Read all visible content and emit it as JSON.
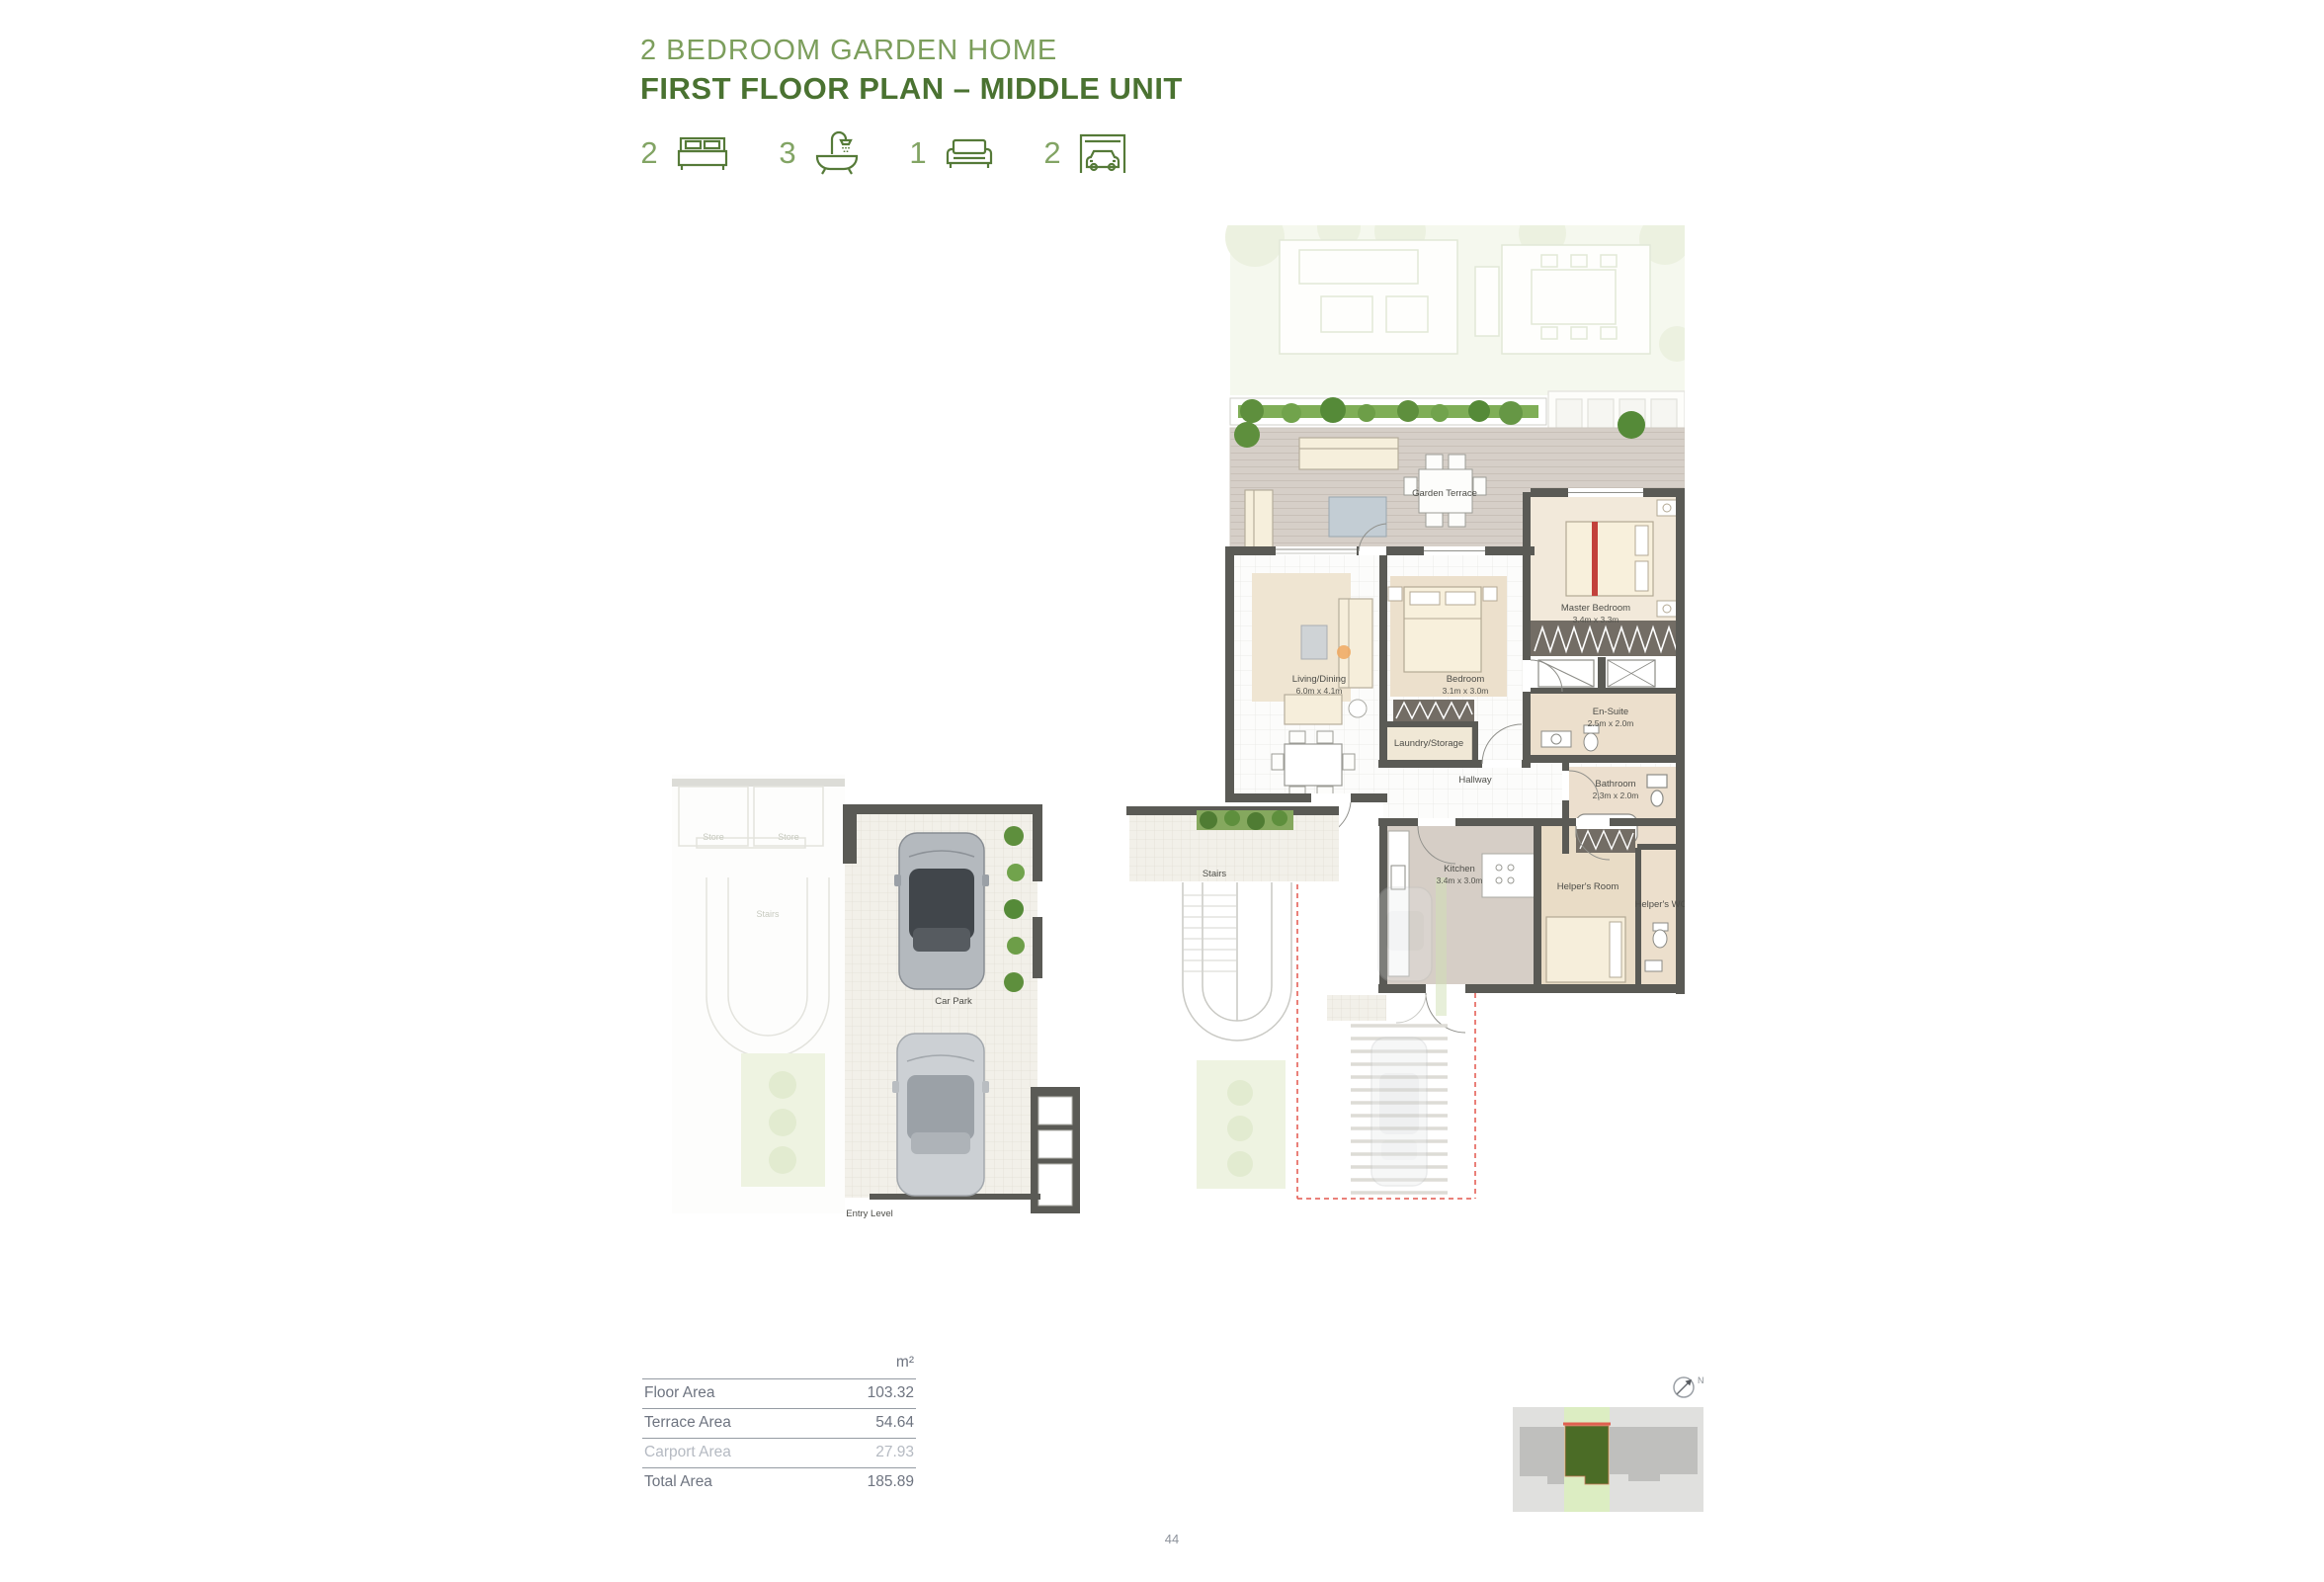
{
  "page": {
    "title": "2 BEDROOM GARDEN HOME",
    "subtitle": "FIRST FLOOR PLAN – MIDDLE UNIT",
    "page_number": "44"
  },
  "unit_stats": [
    {
      "icon": "bed-icon",
      "count": "2"
    },
    {
      "icon": "bath-icon",
      "count": "3"
    },
    {
      "icon": "sofa-icon",
      "count": "1"
    },
    {
      "icon": "garage-icon",
      "count": "2"
    }
  ],
  "floor_plan": {
    "rooms": [
      {
        "name": "Garden Terrace",
        "dims": ""
      },
      {
        "name": "Living/Dining",
        "dims": "6.0m x 4.1m"
      },
      {
        "name": "Bedroom",
        "dims": "3.1m x 3.0m"
      },
      {
        "name": "Master Bedroom",
        "dims": "3.4m x 3.3m"
      },
      {
        "name": "En-Suite",
        "dims": "2.5m x 2.0m"
      },
      {
        "name": "Laundry/Storage",
        "dims": ""
      },
      {
        "name": "Hallway",
        "dims": ""
      },
      {
        "name": "Bathroom",
        "dims": "2.3m x 2.0m"
      },
      {
        "name": "Kitchen",
        "dims": "3.4m x 3.0m"
      },
      {
        "name": "Helper's Room",
        "dims": ""
      },
      {
        "name": "Helper's WC",
        "dims": ""
      },
      {
        "name": "Stairs",
        "dims": ""
      },
      {
        "name": "Car Park",
        "dims": ""
      },
      {
        "name": "Entry Level",
        "dims": ""
      },
      {
        "name": "Store",
        "dims": ""
      },
      {
        "name": "Store",
        "dims": ""
      },
      {
        "name": "Stairs",
        "dims": ""
      }
    ]
  },
  "area_table": {
    "unit_header": "m²",
    "rows": [
      {
        "label": "Floor Area",
        "value": "103.32",
        "muted": false
      },
      {
        "label": "Terrace Area",
        "value": "54.64",
        "muted": false
      },
      {
        "label": "Carport Area",
        "value": "27.93",
        "muted": true
      },
      {
        "label": "Total Area",
        "value": "185.89",
        "muted": false
      }
    ]
  },
  "minimap": {
    "north_label": "N"
  },
  "colors": {
    "accent_green": "#7c9e5c",
    "dark_green": "#4a7231",
    "wall_gray": "#5a5a55",
    "highlight_unit_green": "#4b6c26",
    "boundary_red": "#e4574d"
  }
}
